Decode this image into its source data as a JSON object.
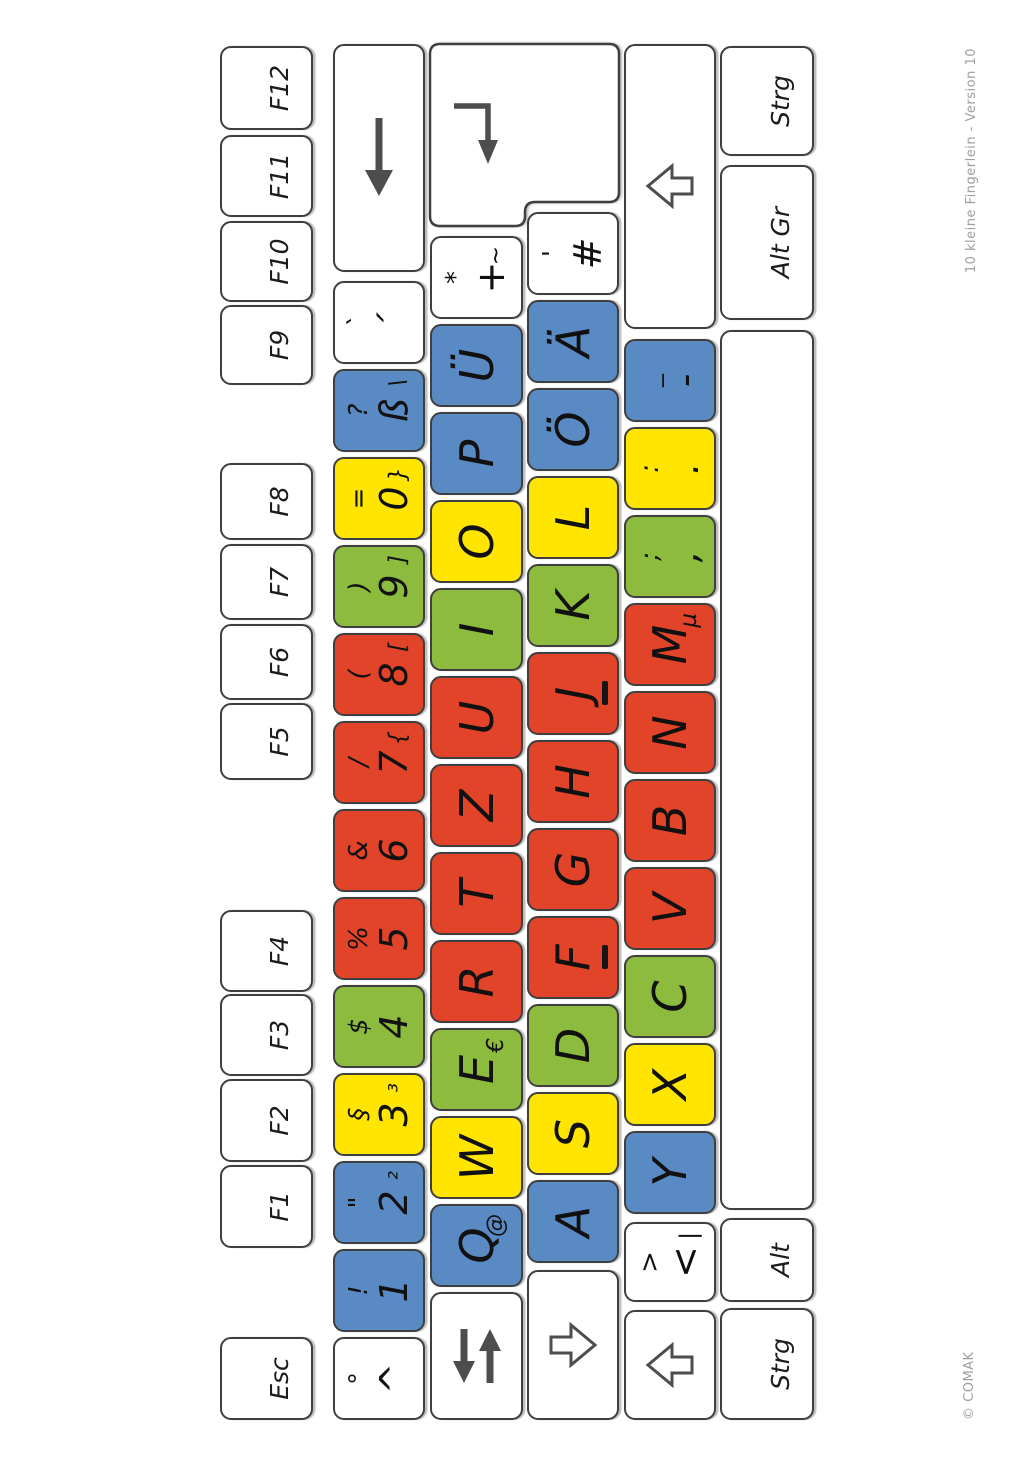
{
  "captions": {
    "left": "© COMAK",
    "right": "10 kleine Fingerlein - Version 10"
  },
  "colors": {
    "pinky": "#5a8ac4",
    "ring": "#ffe500",
    "middle": "#8cbb3d",
    "index": "#e2442a",
    "plain": "#ffffff",
    "border": "#3f3f3f",
    "glyph": "#111111",
    "arrow": "#4d4d4d",
    "caption": "#9e9e9e"
  },
  "keyboard": {
    "rows": [
      {
        "name": "function-row",
        "y": 220,
        "h": 93,
        "keys": [
          {
            "id": "esc",
            "type": "fn",
            "label": "Esc",
            "x": 42,
            "w": 83,
            "color": "plain"
          },
          {
            "id": "f1",
            "type": "fn",
            "label": "F1",
            "x": 214,
            "w": 83,
            "color": "plain"
          },
          {
            "id": "f2",
            "type": "fn",
            "label": "F2",
            "x": 300,
            "w": 83,
            "color": "plain"
          },
          {
            "id": "f3",
            "type": "fn",
            "label": "F3",
            "x": 386,
            "w": 82,
            "color": "plain"
          },
          {
            "id": "f4",
            "type": "fn",
            "label": "F4",
            "x": 470,
            "w": 82,
            "color": "plain"
          },
          {
            "id": "f5",
            "type": "fn",
            "label": "F5",
            "x": 682,
            "w": 77,
            "color": "plain"
          },
          {
            "id": "f6",
            "type": "fn",
            "label": "F6",
            "x": 762,
            "w": 76,
            "color": "plain"
          },
          {
            "id": "f7",
            "type": "fn",
            "label": "F7",
            "x": 842,
            "w": 76,
            "color": "plain"
          },
          {
            "id": "f8",
            "type": "fn",
            "label": "F8",
            "x": 922,
            "w": 77,
            "color": "plain"
          },
          {
            "id": "f9",
            "type": "fn",
            "label": "F9",
            "x": 1077,
            "w": 80,
            "color": "plain"
          },
          {
            "id": "f10",
            "type": "fn",
            "label": "F10",
            "x": 1160,
            "w": 81,
            "color": "plain"
          },
          {
            "id": "f11",
            "type": "fn",
            "label": "F11",
            "x": 1245,
            "w": 82,
            "color": "plain"
          },
          {
            "id": "f12",
            "type": "fn",
            "label": "F12",
            "x": 1332,
            "w": 84,
            "color": "plain"
          }
        ]
      },
      {
        "name": "number-row",
        "y": 333,
        "h": 92,
        "keys": [
          {
            "id": "caret",
            "type": "sym",
            "shift": "°",
            "main": "^",
            "x": 42,
            "w": 83,
            "color": "plain"
          },
          {
            "id": "1",
            "type": "sym",
            "shift": "!",
            "main": "1",
            "x": 130,
            "w": 83,
            "color": "pinky"
          },
          {
            "id": "2",
            "type": "sym",
            "shift": "\"",
            "main": "2",
            "altgr": "²",
            "x": 218,
            "w": 83,
            "color": "pinky"
          },
          {
            "id": "3",
            "type": "sym",
            "shift": "§",
            "main": "3",
            "altgr": "³",
            "x": 306,
            "w": 83,
            "color": "ring"
          },
          {
            "id": "4",
            "type": "sym",
            "shift": "$",
            "main": "4",
            "x": 394,
            "w": 83,
            "color": "middle"
          },
          {
            "id": "5",
            "type": "sym",
            "shift": "%",
            "main": "5",
            "x": 482,
            "w": 83,
            "color": "index"
          },
          {
            "id": "6",
            "type": "sym",
            "shift": "&",
            "main": "6",
            "x": 570,
            "w": 83,
            "color": "index"
          },
          {
            "id": "7",
            "type": "sym",
            "shift": "/",
            "main": "7",
            "altgr": "{",
            "x": 658,
            "w": 83,
            "color": "index"
          },
          {
            "id": "8",
            "type": "sym",
            "shift": "(",
            "main": "8",
            "altgr": "[",
            "x": 746,
            "w": 83,
            "color": "index"
          },
          {
            "id": "9",
            "type": "sym",
            "shift": ")",
            "main": "9",
            "altgr": "]",
            "x": 834,
            "w": 83,
            "color": "middle"
          },
          {
            "id": "0",
            "type": "sym",
            "shift": "=",
            "main": "0",
            "altgr": "}",
            "x": 922,
            "w": 83,
            "color": "ring"
          },
          {
            "id": "eszett",
            "type": "sym",
            "shift": "?",
            "main": "ß",
            "altgr": "\\",
            "x": 1010,
            "w": 83,
            "color": "pinky"
          },
          {
            "id": "acute",
            "type": "sym",
            "shift": "`",
            "main": "´",
            "x": 1098,
            "w": 83,
            "color": "plain"
          },
          {
            "id": "backspace",
            "type": "icon",
            "icon": "backspace",
            "x": 1190,
            "w": 228,
            "color": "plain"
          }
        ]
      },
      {
        "name": "tab-row",
        "y": 430,
        "h": 93,
        "keys": [
          {
            "id": "tab",
            "type": "icon",
            "icon": "tab",
            "x": 42,
            "w": 128,
            "color": "plain"
          },
          {
            "id": "q",
            "type": "letter",
            "main": "Q",
            "altgr": "@",
            "x": 175,
            "w": 83,
            "color": "pinky"
          },
          {
            "id": "w",
            "type": "letter",
            "main": "W",
            "x": 263,
            "w": 83,
            "color": "ring"
          },
          {
            "id": "e",
            "type": "letter",
            "main": "E",
            "altgr": "€",
            "x": 351,
            "w": 83,
            "color": "middle"
          },
          {
            "id": "r",
            "type": "letter",
            "main": "R",
            "x": 439,
            "w": 83,
            "color": "index"
          },
          {
            "id": "t",
            "type": "letter",
            "main": "T",
            "x": 527,
            "w": 83,
            "color": "index"
          },
          {
            "id": "z",
            "type": "letter",
            "main": "Z",
            "x": 615,
            "w": 83,
            "color": "index"
          },
          {
            "id": "u",
            "type": "letter",
            "main": "U",
            "x": 703,
            "w": 83,
            "color": "index"
          },
          {
            "id": "i",
            "type": "letter",
            "main": "I",
            "x": 791,
            "w": 83,
            "color": "middle"
          },
          {
            "id": "o",
            "type": "letter",
            "main": "O",
            "x": 879,
            "w": 83,
            "color": "ring"
          },
          {
            "id": "p",
            "type": "letter",
            "main": "P",
            "x": 967,
            "w": 83,
            "color": "pinky"
          },
          {
            "id": "uuml",
            "type": "letter",
            "main": "Ü",
            "x": 1055,
            "w": 83,
            "color": "pinky"
          },
          {
            "id": "plus",
            "type": "sym",
            "shift": "*",
            "main": "+",
            "altgr": "~",
            "x": 1143,
            "w": 83,
            "color": "plain"
          },
          {
            "id": "enter",
            "type": "enter",
            "x": 1234,
            "w": 186,
            "color": "plain"
          }
        ]
      },
      {
        "name": "home-row",
        "y": 527,
        "h": 92,
        "keys": [
          {
            "id": "caps-lock",
            "type": "icon",
            "icon": "caps",
            "x": 42,
            "w": 150,
            "color": "plain"
          },
          {
            "id": "a",
            "type": "letter",
            "main": "A",
            "x": 199,
            "w": 83,
            "color": "pinky"
          },
          {
            "id": "s",
            "type": "letter",
            "main": "S",
            "x": 287,
            "w": 83,
            "color": "ring"
          },
          {
            "id": "d",
            "type": "letter",
            "main": "D",
            "x": 375,
            "w": 83,
            "color": "middle"
          },
          {
            "id": "f",
            "type": "letter",
            "main": "F",
            "home": true,
            "x": 463,
            "w": 83,
            "color": "index"
          },
          {
            "id": "g",
            "type": "letter",
            "main": "G",
            "x": 551,
            "w": 83,
            "color": "index"
          },
          {
            "id": "h",
            "type": "letter",
            "main": "H",
            "x": 639,
            "w": 83,
            "color": "index"
          },
          {
            "id": "j",
            "type": "letter",
            "main": "J",
            "home": true,
            "x": 727,
            "w": 83,
            "color": "index"
          },
          {
            "id": "k",
            "type": "letter",
            "main": "K",
            "x": 815,
            "w": 83,
            "color": "middle"
          },
          {
            "id": "l",
            "type": "letter",
            "main": "L",
            "x": 903,
            "w": 83,
            "color": "ring"
          },
          {
            "id": "ouml",
            "type": "letter",
            "main": "Ö",
            "x": 991,
            "w": 83,
            "color": "pinky"
          },
          {
            "id": "auml",
            "type": "letter",
            "main": "Ä",
            "x": 1079,
            "w": 83,
            "color": "pinky"
          },
          {
            "id": "hash",
            "type": "sym",
            "shift": "'",
            "main": "#",
            "x": 1167,
            "w": 83,
            "color": "plain"
          }
        ]
      },
      {
        "name": "shift-row",
        "y": 624,
        "h": 92,
        "keys": [
          {
            "id": "shift-left",
            "type": "icon",
            "icon": "shift",
            "x": 42,
            "w": 110,
            "color": "plain"
          },
          {
            "id": "angle",
            "type": "sym",
            "shift": ">",
            "main": "<",
            "altgr": "|",
            "x": 160,
            "w": 80,
            "color": "plain"
          },
          {
            "id": "y",
            "type": "letter",
            "main": "Y",
            "x": 248,
            "w": 83,
            "color": "pinky"
          },
          {
            "id": "x",
            "type": "letter",
            "main": "X",
            "x": 336,
            "w": 83,
            "color": "ring"
          },
          {
            "id": "c",
            "type": "letter",
            "main": "C",
            "x": 424,
            "w": 83,
            "color": "middle"
          },
          {
            "id": "v",
            "type": "letter",
            "main": "V",
            "x": 512,
            "w": 83,
            "color": "index"
          },
          {
            "id": "b",
            "type": "letter",
            "main": "B",
            "x": 600,
            "w": 83,
            "color": "index"
          },
          {
            "id": "n",
            "type": "letter",
            "main": "N",
            "x": 688,
            "w": 83,
            "color": "index"
          },
          {
            "id": "m",
            "type": "letter",
            "main": "M",
            "altgr": "µ",
            "x": 776,
            "w": 83,
            "color": "index"
          },
          {
            "id": "comma",
            "type": "sym",
            "shift": ";",
            "main": ",",
            "x": 864,
            "w": 83,
            "color": "middle"
          },
          {
            "id": "period",
            "type": "sym",
            "shift": ":",
            "main": ".",
            "x": 952,
            "w": 83,
            "color": "ring"
          },
          {
            "id": "minus",
            "type": "sym",
            "shift": "_",
            "main": "-",
            "x": 1040,
            "w": 83,
            "color": "pinky"
          },
          {
            "id": "shift-right",
            "type": "icon",
            "icon": "shift",
            "x": 1133,
            "w": 285,
            "color": "plain"
          }
        ]
      },
      {
        "name": "control-row",
        "y": 720,
        "h": 94,
        "keys": [
          {
            "id": "strg-left",
            "type": "mod",
            "label": "Strg",
            "x": 42,
            "w": 112,
            "color": "plain"
          },
          {
            "id": "alt",
            "type": "mod",
            "label": "Alt",
            "x": 160,
            "w": 84,
            "color": "plain"
          },
          {
            "id": "space",
            "type": "space",
            "x": 252,
            "w": 880,
            "color": "plain"
          },
          {
            "id": "alt-gr",
            "type": "mod",
            "label": "Alt Gr",
            "x": 1142,
            "w": 155,
            "color": "plain"
          },
          {
            "id": "strg-right",
            "type": "mod",
            "label": "Strg",
            "x": 1306,
            "w": 110,
            "color": "plain"
          }
        ]
      }
    ]
  }
}
